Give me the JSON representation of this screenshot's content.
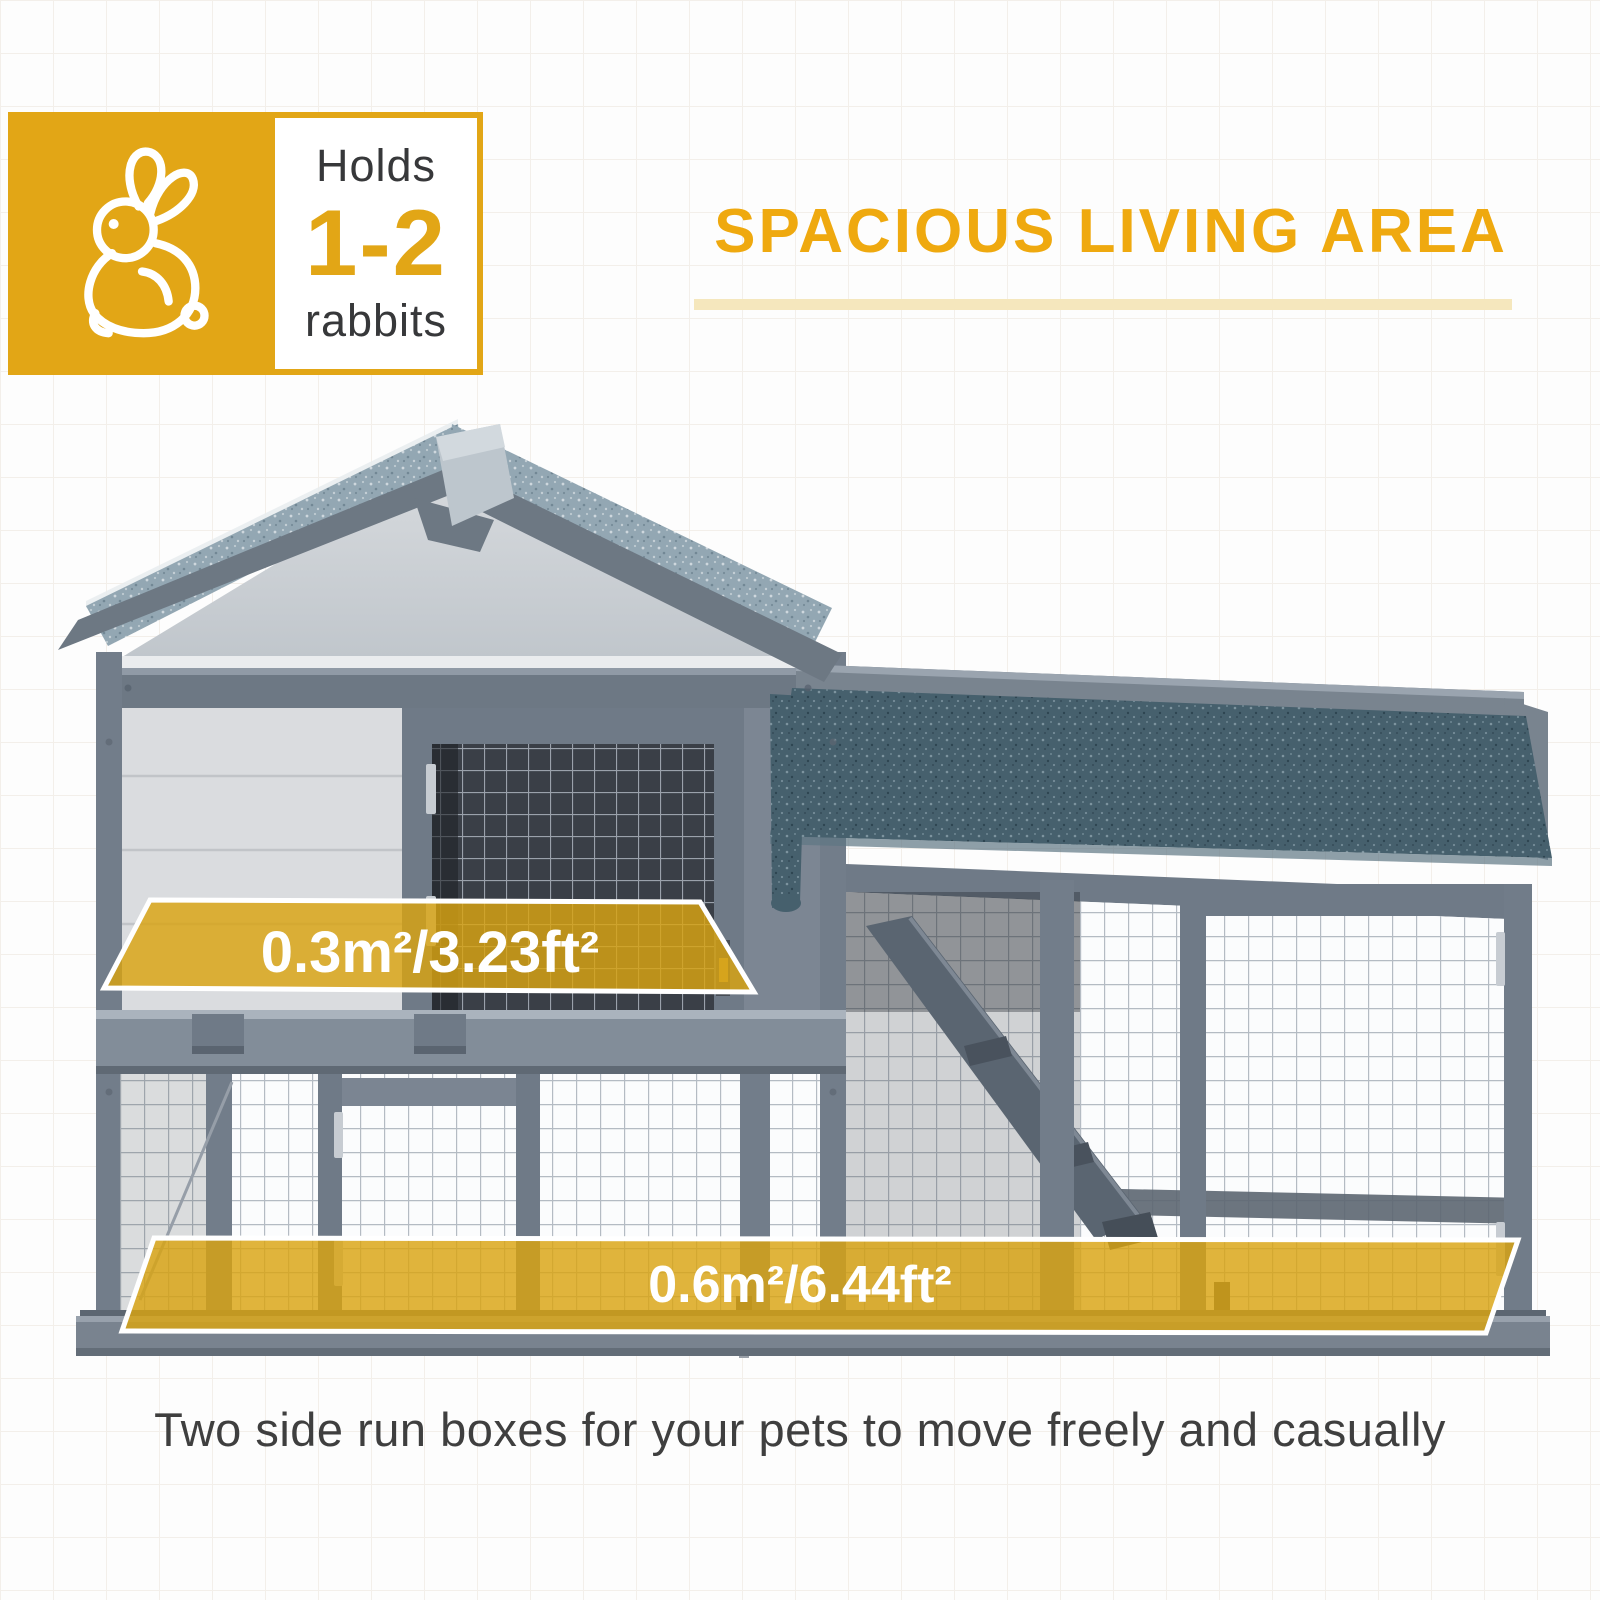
{
  "badge": {
    "icon": "rabbit-icon",
    "holds": "Holds",
    "count": "1-2",
    "animal": "rabbits"
  },
  "header": {
    "title": "SPACIOUS LIVING AREA"
  },
  "overlays": {
    "upper_area": "0.3m²/3.23ft²",
    "lower_area": "0.6m²/6.44ft²"
  },
  "caption": "Two side run boxes for your pets to move freely and casually",
  "colors": {
    "badge_yellow": "#E2A616",
    "accent_yellow": "#EFA90F",
    "underline_yellow": "#F5E7BD",
    "overlay_yellow": "#D9A411",
    "overlay_border": "#FFFFFF",
    "label_text": "#37383A",
    "caption_text": "#3F3F3F",
    "background": "#FDFDFD",
    "grid_line": "#F3EFEA",
    "wood_gray": "#6F7A87",
    "panel_white": "#DADCDF",
    "roof_asphalt_light": "#93A7B3",
    "roof_asphalt_dark": "#46606D",
    "ridge_cap": "#BDC6CD",
    "mesh_wire": "#B4BBC3"
  }
}
